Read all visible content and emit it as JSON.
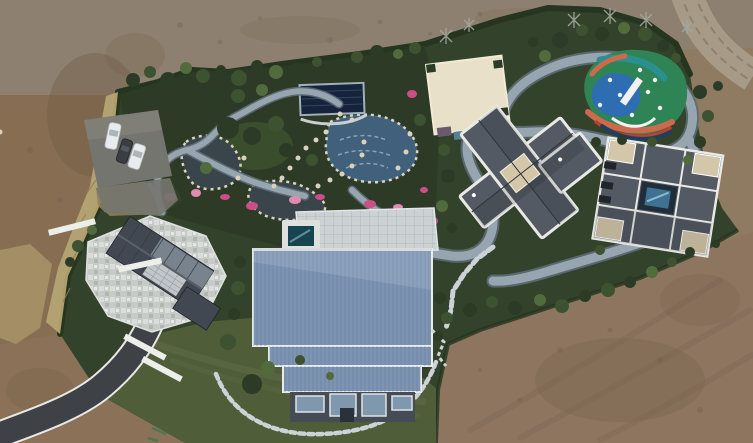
{
  "meta": {
    "domain": "aerial-drone-photograph",
    "description": "Overhead drone view of a landscaped private estate compound surrounded by bare tilled dirt. Inside the dark-green hedged grounds: a rock-edged pond garden with pink azaleas and a covered pool, winding light-gray stone walking paths, a large blue standing-seam-roof barn house, a left house with dark gable roof and white mosaic patio, a cream flat-roofed building, two gray-roofed villas (one cross-plan, one square with a small courtyard pool), a multicolored children's playground, an open lawn, a parking pad with three cars, a curving asphalt driveway entering bottom-left and a dirt track entering top-right.",
    "image_width_px": 753,
    "image_height_px": 443
  },
  "palette": {
    "dirt_mid": "#8f7a62",
    "dirt_top": "#8e8070",
    "dirt_left": "#876e53",
    "dirt_br": "#8d7560",
    "dirt_bl": "#8a7158",
    "dirt_dark": "#6e5a42",
    "road_dirt": "#a79a86",
    "road_track": "#8a7c67",
    "hedge": "#26351f",
    "veg_base": "#33422a",
    "veg_dark": "#2c3b26",
    "veg_mid": "#3d5230",
    "veg_light": "#516b3c",
    "lawn": "#4f5d39",
    "lawn_light": "#5f6f45",
    "dry_grass": "#b5a473",
    "dry_grass_dark": "#8f8257",
    "path_gray": "#97a5b0",
    "path_edge": "#5f6d78",
    "stone_white": "#ccd1d3",
    "stepping_stone": "#ccd2d5",
    "water_dark": "#3a454b",
    "water_blue": "#41607c",
    "pool_cover": "#17233a",
    "hot_tub_water": "#17454f",
    "courtyard_pool": "#3f7291",
    "pink": "#c94f86",
    "pink_light": "#e08bb0",
    "barn_roof": "#7d94b2",
    "barn_rib": "#5f7694",
    "barn_facade": "#464c55",
    "window_blue": "#7f98ad",
    "house_roof": "#424852",
    "house_glass": "#828e99",
    "patio_mosaic": "#c7cbc8",
    "cream_roof": "#e8e0c9",
    "villa_roof": "#535a64",
    "villa_trim": "#e9e9e6",
    "beige_flat": "#d3c6a9",
    "asphalt": "#3e4145",
    "asphalt_edge": "#e8e8e4",
    "parking_pad": "#75756f",
    "car_white": "#e9ecee",
    "car_dark": "#3a3d42",
    "pg_green": "#2f8455",
    "pg_blue": "#2f6db3",
    "pg_teal": "#2a8f8f",
    "pg_orange": "#cd6a4e",
    "pg_red": "#b8432f",
    "pg_navy": "#1e3f63",
    "equip_white": "#f2f3f1",
    "bare_tree": "#a3a89f",
    "rock": "#d9d2bd",
    "paint_green": "#3f7a4f"
  },
  "scene": {
    "ground": {
      "bare_dirt": "tilled tan-brown earth on top, left and bottom-right",
      "dirt_road": "light tan vehicle track entering at top-right corner",
      "asphalt_driveway": "dark paved drive with white edge lines entering from bottom-left"
    },
    "compound": {
      "boundary": "dark evergreen hedge line",
      "vegetation": "dense round shrubs and trees",
      "lawn": "open green lawn at bottom center",
      "dry_grass": "tall tan ornamental grass band along the left boundary"
    },
    "water_features": {
      "ponds": 3,
      "covered_pool": 1,
      "hot_tub": 1,
      "courtyard_pool": 1
    },
    "buildings": [
      {
        "name": "blue-roof-barn",
        "position": "center",
        "roof": "light steel-blue ribbed metal, stepped plan, glazed lower facade"
      },
      {
        "name": "left-house",
        "position": "left",
        "roof": "dark gray gable with glass section, large white mosaic patio"
      },
      {
        "name": "cream-flat-roof-building",
        "position": "top center-right",
        "roof": "cream flat roof with notched corners"
      },
      {
        "name": "cross-villa",
        "position": "center-right",
        "roof": "dark gray hip roofs with white parapet trim, rotated cross plan"
      },
      {
        "name": "square-villa",
        "position": "far right",
        "roof": "dark gray with white trim, beige corner decks, small blue courtyard pool"
      }
    ],
    "playground": {
      "surface_colors": [
        "green",
        "blue",
        "teal",
        "orange",
        "red",
        "navy"
      ],
      "equipment": "white slide and climbing pieces"
    },
    "vehicles": {
      "count": 3,
      "colors": [
        "white",
        "dark-gray",
        "white"
      ],
      "location": "parking pad upper-left"
    },
    "flowers": "pink azalea patches ringing the ponds"
  }
}
